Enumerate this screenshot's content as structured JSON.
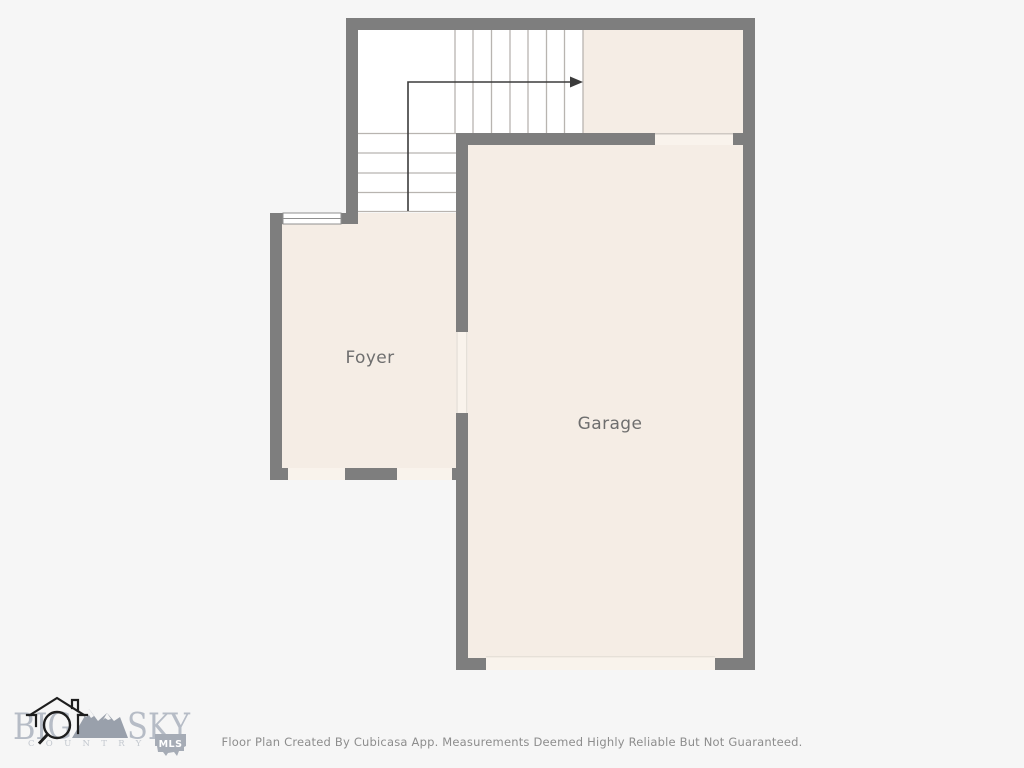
{
  "palette": {
    "background": "#f6f6f6",
    "wall": "#7e7e7e",
    "floor": "#f5ede5",
    "threshold": "#f9f3ec",
    "stair_area": "#ffffff",
    "tread_line": "#b8b4b0",
    "arrow": "#3b3b3b",
    "room_label": "#6e6e6e",
    "footer_text": "#8d8d8d",
    "logo_text": "#b6bcc6",
    "logo_mountain": "#99a0ab",
    "logo_badge": "#a6acb6"
  },
  "floor_plan": {
    "rooms": [
      {
        "label": "Foyer"
      },
      {
        "label": "Garage"
      }
    ],
    "icons": {
      "stairs_arrow": "stairs-direction-arrow",
      "window": "window-symbol"
    }
  },
  "branding": {
    "big": "BIG",
    "sky": "SKY",
    "country": "COUNTRY",
    "badge": "MLS"
  },
  "footer": {
    "disclaimer": "Floor Plan Created By Cubicasa App. Measurements Deemed Highly Reliable But Not Guaranteed."
  }
}
